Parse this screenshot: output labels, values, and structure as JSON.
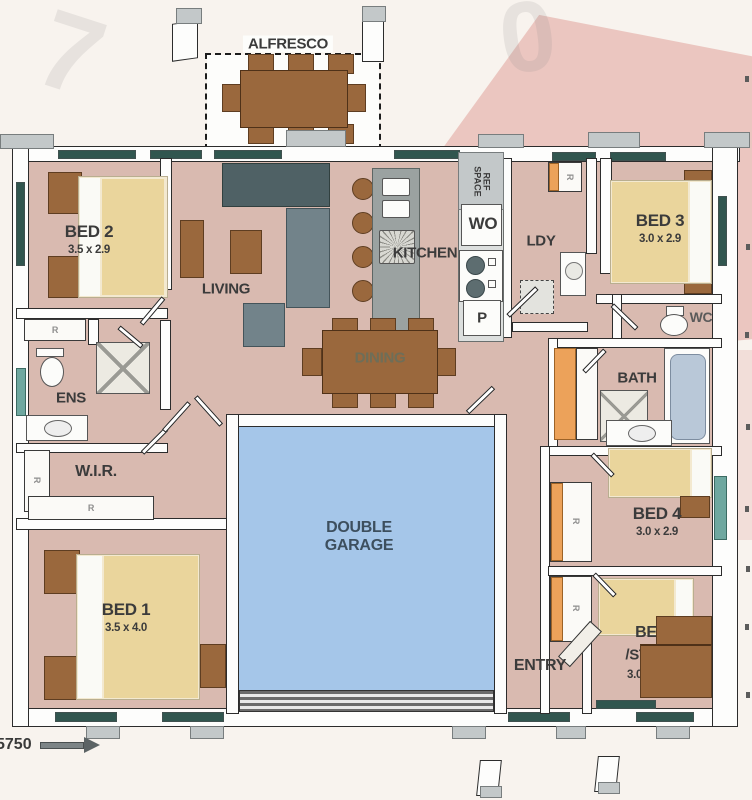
{
  "plan": {
    "alfresco": "ALFRESCO",
    "rooms": {
      "bed1": {
        "name": "BED 1",
        "dims": "3.5 x 4.0"
      },
      "bed2": {
        "name": "BED 2",
        "dims": "3.5 x 2.9"
      },
      "bed3": {
        "name": "BED 3",
        "dims": "3.0 x 2.9"
      },
      "bed4": {
        "name": "BED 4",
        "dims": "3.0 x 2.9"
      },
      "bed5": {
        "name": "BED 5",
        "alt": "/STUDY",
        "dims": "3.0 x 2.9"
      },
      "living": "LIVING",
      "kitchen": "KITCHEN",
      "dining": "DINING",
      "laundry": "LDY",
      "ensuite": "ENS",
      "wir": "W.I.R.",
      "bath": "BATH",
      "wc": "WC",
      "entry": "ENTRY",
      "garage_line1": "DOUBLE",
      "garage_line2": "GARAGE"
    },
    "fixtures": {
      "ref_space": "REF SPACE",
      "wall_oven": "WO",
      "pantry": "P",
      "robe": "R"
    },
    "dimension_marker": "5750"
  },
  "colors": {
    "floor": "#d9bab0",
    "garage_floor": "#a5c6e9",
    "window_glass": "#31564f",
    "timber": "#9a683d",
    "robe_orange": "#eca25a",
    "watermark_red": "#cd5f55",
    "garage_text": "#3d4f5e"
  }
}
